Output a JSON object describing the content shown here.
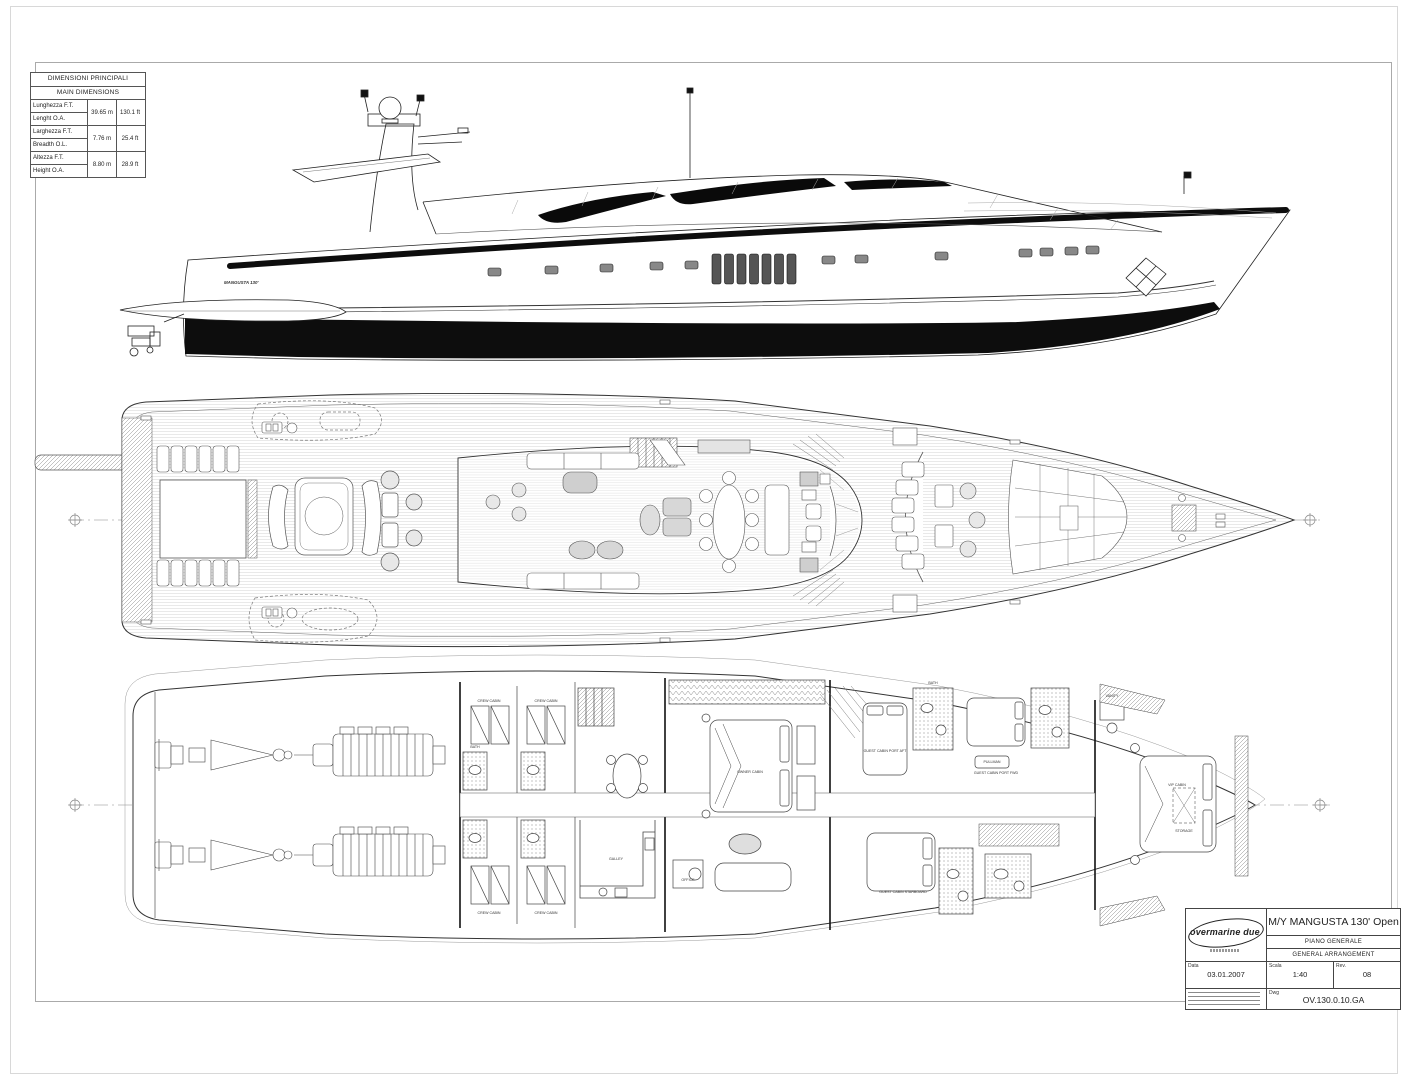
{
  "document": {
    "type": "general-arrangement-drawing",
    "ink_color": "#1a1a1a"
  },
  "dimensions_table": {
    "title_it": "DIMENSIONI PRINCIPALI",
    "title_en": "MAIN DIMENSIONS",
    "rows": [
      {
        "label_it": "Lunghezza F.T.",
        "label_en": "Lenght O.A.",
        "metric": "39.65 m",
        "imperial": "130.1 ft"
      },
      {
        "label_it": "Larghezza F.T.",
        "label_en": "Breadth O.L.",
        "metric": "7.76 m",
        "imperial": "25.4 ft"
      },
      {
        "label_it": "Altezza F.T.",
        "label_en": "Height O.A.",
        "metric": "8.80 m",
        "imperial": "28.9 ft"
      }
    ]
  },
  "profile": {
    "hull_name": "MANGUSTA 130'"
  },
  "lower_deck": {
    "labels": [
      "CREW CABIN",
      "CREW CABIN",
      "CREW CABIN",
      "CREW CABIN",
      "GALLEY",
      "OWNER CABIN",
      "OFFICE",
      "GUEST CABIN PORT AFT",
      "GUEST CABIN PORT FWD",
      "GUEST CABIN STARBOARD",
      "PULLMAN",
      "VIP CABIN",
      "STORAGE",
      "VANITY",
      "BATH",
      "BATH"
    ]
  },
  "title_block": {
    "logo_text": "overmarine due",
    "project_title": "M/Y MANGUSTA 130' Open",
    "subtitle_it": "PIANO GENERALE",
    "subtitle_en": "GENERAL ARRANGEMENT",
    "date_label": "Data",
    "date_value": "03.01.2007",
    "scale_label": "Scala",
    "scale_value": "1:40",
    "rev_label": "Rev.",
    "rev_value": "08",
    "dwg_label": "Dwg",
    "dwg_value": "OV.130.0.10.GA"
  }
}
